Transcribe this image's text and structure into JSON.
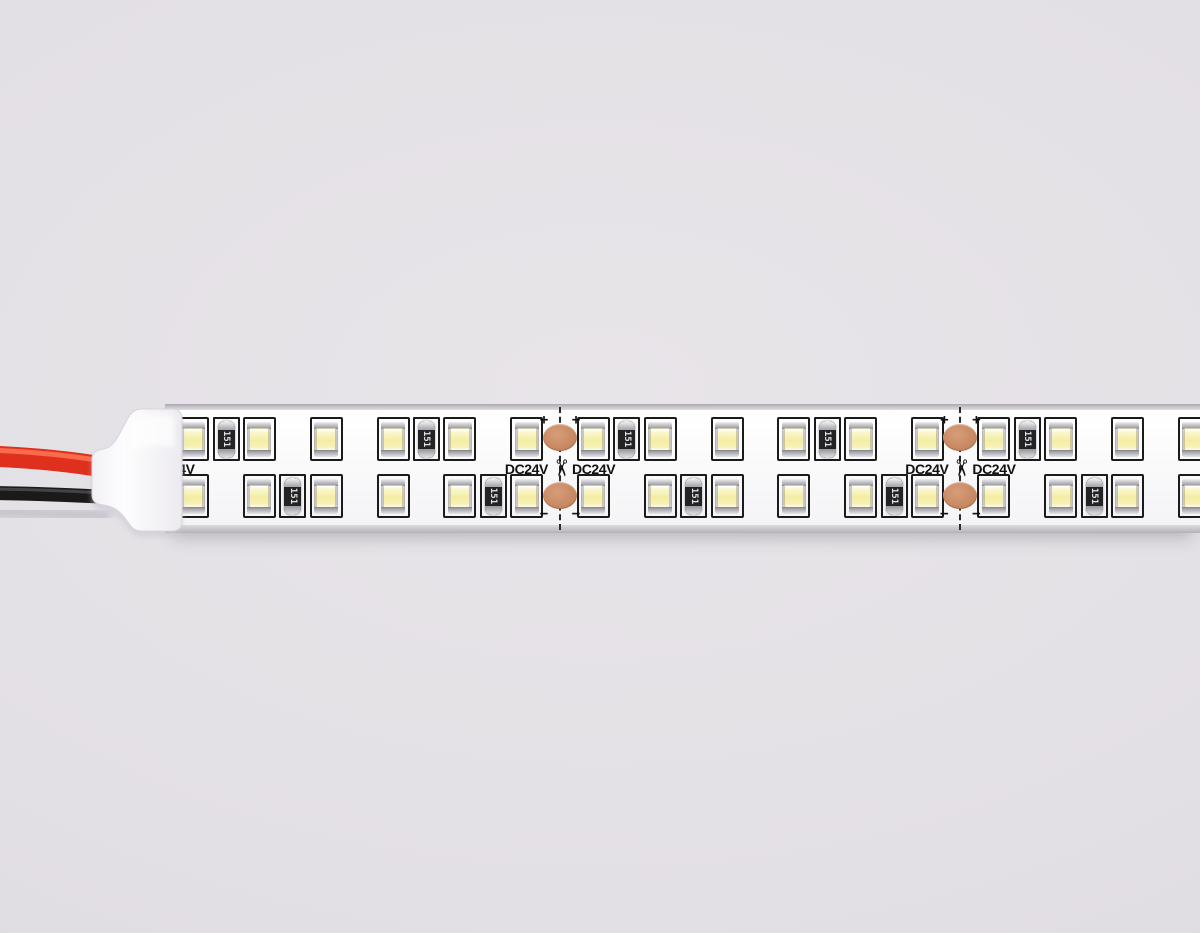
{
  "page": {
    "width": 1200,
    "height": 933,
    "background": "#e3e0e5"
  },
  "strip": {
    "left": 165,
    "top": 404,
    "width": 1035,
    "height": 129,
    "colors": {
      "pcb": "#fbfbfc",
      "silkscreen": "#1b1b1b",
      "copper_pad": "#c98a66",
      "led_window": "#f3eda3"
    },
    "geometry": {
      "cut_xs": [
        159.2,
        560,
        960.4
      ],
      "segment_length": 400.8,
      "led_pitch": 66.8,
      "leds_per_segment": 6,
      "row_tops": [
        13,
        70
      ],
      "top_row_resistor_slots": [
        0,
        3
      ],
      "bottom_row_resistor_slots": [
        1,
        4
      ],
      "pad_top_y": 20,
      "pad_bottom_y": 78,
      "label_center_y": 65,
      "plus_y": 16,
      "minus_y": 110
    },
    "labels": {
      "voltage": "DC24V",
      "voltage_partial": "4V",
      "resistor": "151",
      "plus": "+",
      "minus": "−",
      "scissors": "✂"
    }
  },
  "wires": {
    "red_color": "#df2f1d",
    "red_highlight": "#ff7456",
    "black_color": "#1a1a1a",
    "black_highlight": "#4e4e52"
  },
  "end_cap": {
    "color_light": "#fdfdfe",
    "color_dark": "#e7e5ea"
  }
}
